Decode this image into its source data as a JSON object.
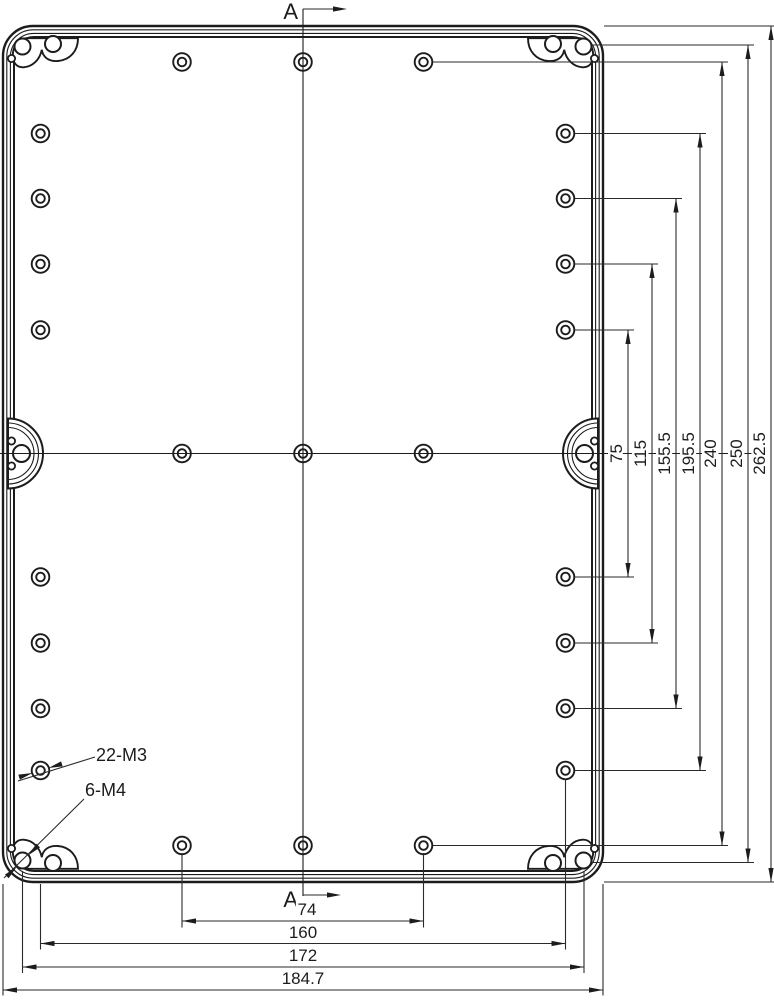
{
  "drawing": {
    "type": "technical-drawing",
    "section": {
      "label": "A"
    },
    "callouts": {
      "bosses": "22-M3",
      "screws": "6-M4"
    },
    "dims": {
      "bottom": [
        "74",
        "160",
        "172",
        "184.7"
      ],
      "right": [
        "75",
        "115",
        "155.5",
        "195.5",
        "240",
        "250",
        "262.5"
      ]
    },
    "colors": {
      "line": "#1c1c1c",
      "background": "#ffffff"
    }
  }
}
